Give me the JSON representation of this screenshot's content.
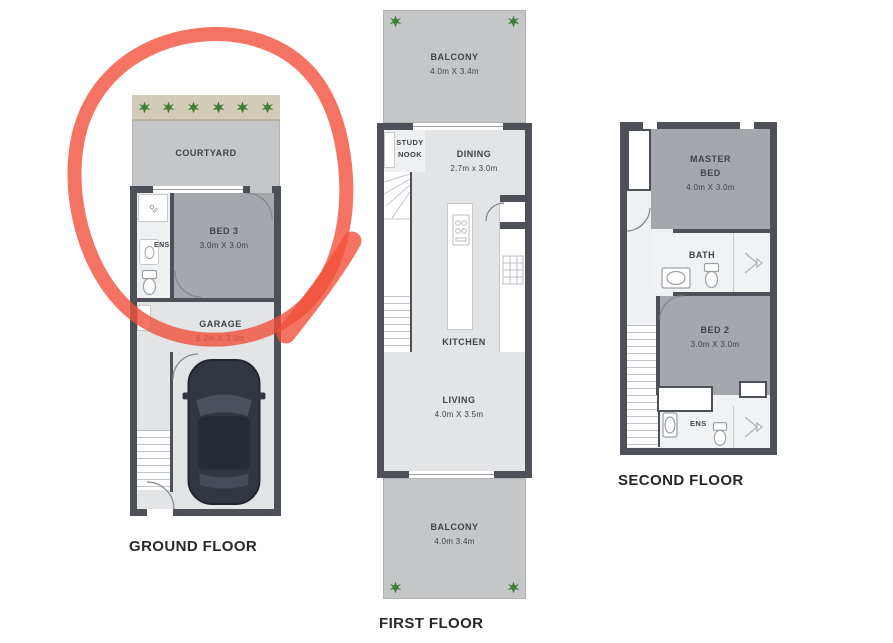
{
  "colors": {
    "wall": "#4d5157",
    "floor": "#e2e4e6",
    "wet": "#eef0f2",
    "room": "#a4a8ac",
    "outdoor": "#c5c6c8",
    "garden": "#d2cbb8",
    "plant": "#3e7d35",
    "red": "#f1503b",
    "text": "#3f434a",
    "title": "#26282b",
    "line": "#c6c9cc",
    "fixture": "#9ba0a5"
  },
  "plans": {
    "ground": {
      "title": "GROUND FLOOR",
      "rooms": {
        "courtyard": "COURTYARD",
        "bed3_name": "BED 3",
        "bed3_dims": "3.0m X 3.0m",
        "ens": "ENS",
        "garage_name": "GARAGE",
        "garage_dims": "6.2m X 3.0m"
      }
    },
    "first": {
      "title": "FIRST FLOOR",
      "rooms": {
        "balcony_top_name": "BALCONY",
        "balcony_top_dims": "4.0m X 3.4m",
        "study_line1": "STUDY",
        "study_line2": "NOOK",
        "dining_name": "DINING",
        "dining_dims": "2.7m x 3.0m",
        "kitchen": "KITCHEN",
        "living_name": "LIVING",
        "living_dims": "4.0m X 3.5m",
        "balcony_bottom_name": "BALCONY",
        "balcony_bottom_dims": "4.0m 3.4m"
      }
    },
    "second": {
      "title": "SECOND FLOOR",
      "rooms": {
        "master_line1": "MASTER",
        "master_line2": "BED",
        "master_dims": "4.0m X 3.0m",
        "bath": "BATH",
        "bed2_name": "BED 2",
        "bed2_dims": "3.0m X 3.0m",
        "ens": "ENS"
      }
    }
  },
  "annotation": {
    "shape": "hand-drawn-circle",
    "color": "#f1503b"
  }
}
